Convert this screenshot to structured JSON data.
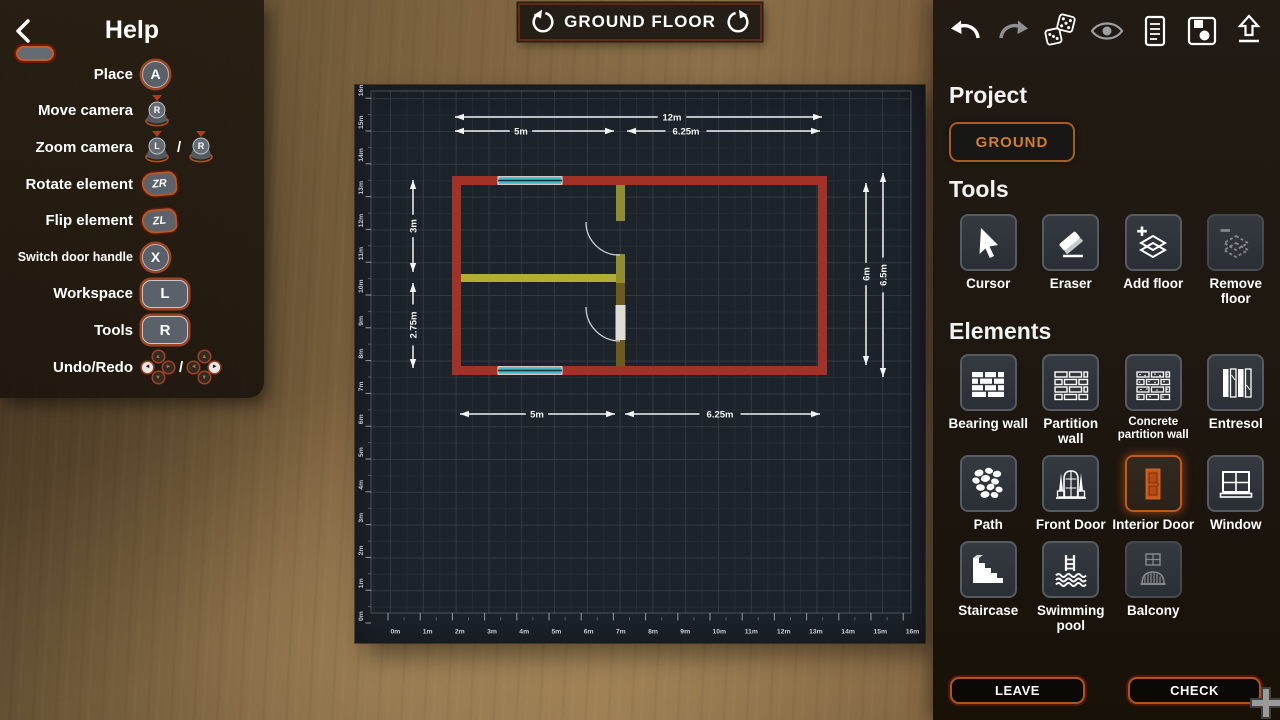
{
  "help": {
    "title": "Help",
    "rows": [
      {
        "label": "Place",
        "key": "A"
      },
      {
        "label": "Move camera",
        "key": "R"
      },
      {
        "label": "Zoom camera",
        "key_l": "L",
        "key_r": "R",
        "separator": "/"
      },
      {
        "label": "Rotate element",
        "key": "ZR"
      },
      {
        "label": "Flip element",
        "key": "ZL"
      },
      {
        "label": "Switch door handle",
        "key": "X"
      },
      {
        "label": "Workspace",
        "key": "L"
      },
      {
        "label": "Tools",
        "key": "R"
      },
      {
        "label": "Undo/Redo",
        "separator": "/"
      }
    ]
  },
  "header": {
    "title": "GROUND FLOOR"
  },
  "toolbar_icons": [
    "undo",
    "redo",
    "randomize-dice",
    "visibility-eye",
    "notes-document",
    "save-floppy",
    "export-upload"
  ],
  "project": {
    "heading": "Project",
    "button_label": "GROUND"
  },
  "tools": {
    "heading": "Tools",
    "items": [
      {
        "label": "Cursor"
      },
      {
        "label": "Eraser"
      },
      {
        "label": "Add floor"
      },
      {
        "label": "Remove floor",
        "disabled": true
      }
    ]
  },
  "elements": {
    "heading": "Elements",
    "items": [
      {
        "label": "Bearing wall"
      },
      {
        "label": "Partition wall"
      },
      {
        "label": "Concrete partition wall"
      },
      {
        "label": "Entresol"
      },
      {
        "label": "Path"
      },
      {
        "label": "Front Door"
      },
      {
        "label": "Interior Door",
        "selected": true
      },
      {
        "label": "Window"
      },
      {
        "label": "Staircase"
      },
      {
        "label": "Swimming pool"
      },
      {
        "label": "Balcony",
        "disabled": true
      }
    ]
  },
  "footer": {
    "leave": "LEAVE",
    "check": "CHECK"
  },
  "blueprint": {
    "dimensions": {
      "top_total": "12m",
      "top_left": "5m",
      "top_right": "6.25m",
      "bottom_left": "5m",
      "bottom_right": "6.25m",
      "left_upper": "3m",
      "left_lower": "2.75m",
      "right_inner": "6m",
      "right_outer": "6.5m"
    },
    "ruler_x": [
      "0m",
      "1m",
      "2m",
      "3m",
      "4m",
      "5m",
      "6m",
      "7m",
      "8m",
      "9m",
      "10m",
      "11m",
      "12m",
      "13m",
      "14m",
      "15m",
      "16m"
    ],
    "ruler_y": [
      "0m",
      "1m",
      "2m",
      "3m",
      "4m",
      "5m",
      "6m",
      "7m",
      "8m",
      "9m",
      "10m",
      "11m",
      "12m",
      "13m",
      "14m",
      "15m",
      "16m"
    ],
    "colors": {
      "bearing_wall": "#a23128",
      "partition_wall": "#b2ad33",
      "window": "#41b9c8",
      "canvas_bg": "#1c232a",
      "accent_orange": "#c05a18"
    }
  }
}
